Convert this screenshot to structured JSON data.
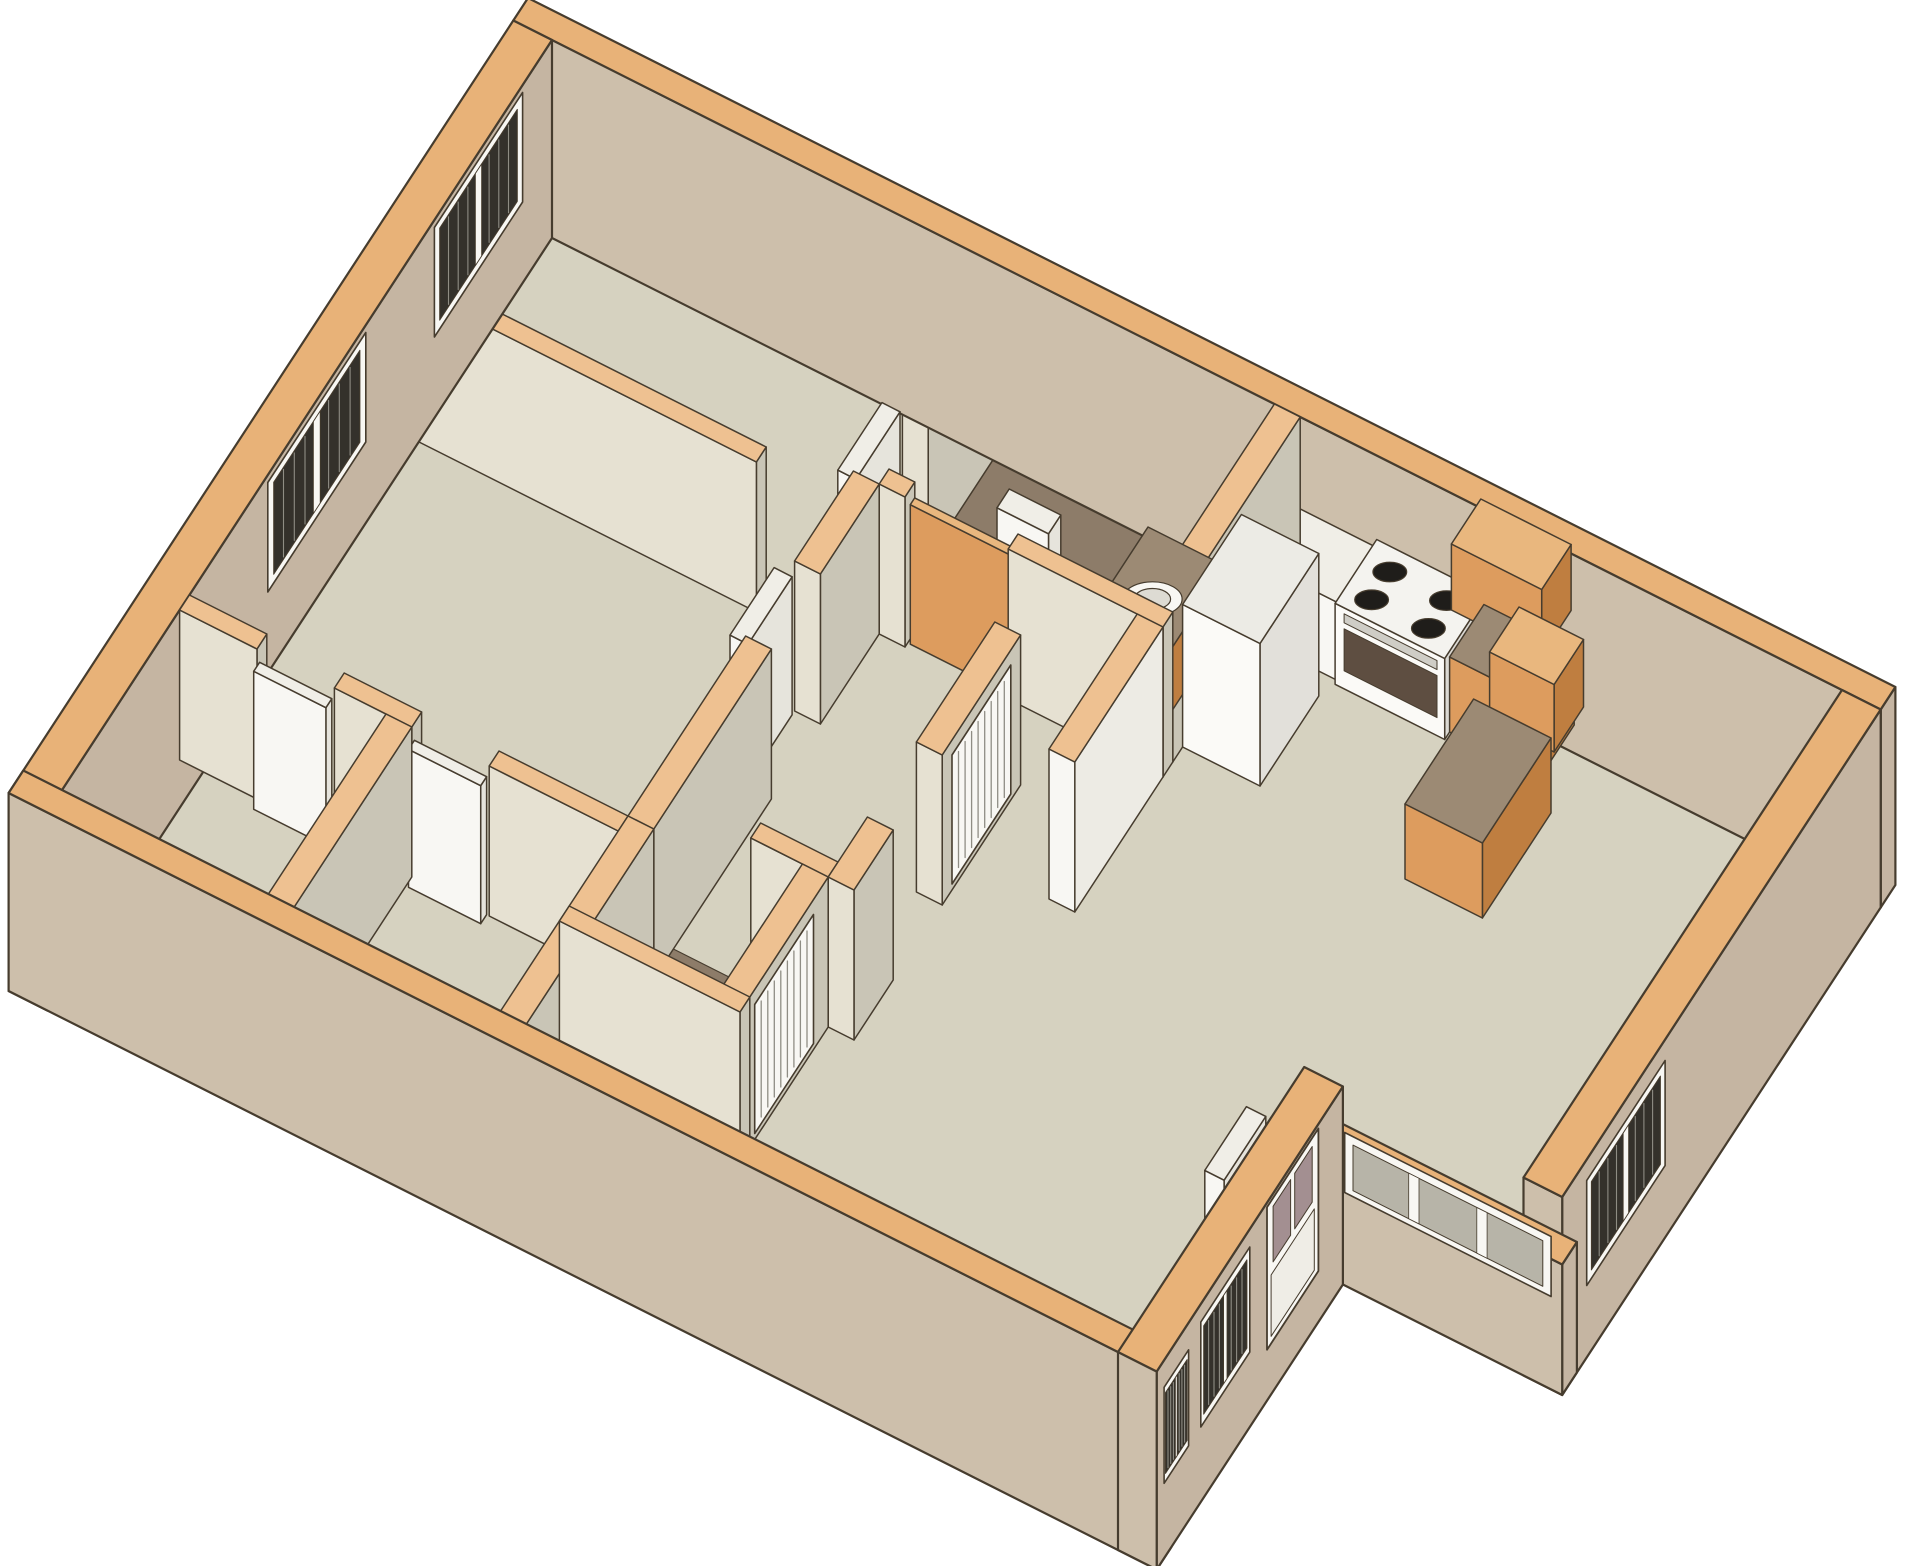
{
  "meta": {
    "title": "3D apartment floor plan",
    "description": "Isometric 3D cutaway floor plan of a two-bedroom apartment with two bedrooms on the left, a central hallway with louvered closets, two bathrooms with sinks and toilet, a kitchen with orange cabinets and a white stove, and an open living and dining area with an entry door and blinded windows"
  },
  "projection": {
    "origin": [
      552,
      190
    ],
    "u": [
      12.9,
      6.5
    ],
    "v": [
      -4.9,
      7.5
    ],
    "wall_height_px": 150,
    "slab_depth": -0.32,
    "canvas": [
      1920,
      1566
    ]
  },
  "colors": {
    "background": "#ffffff",
    "outline": "#463c2e",
    "floor": "#d6d2c0",
    "bathFloor": "#8d7c69",
    "topExt": "#e8b278",
    "topInt": "#eec191",
    "extS": "#cdbfab",
    "extE": "#c5b5a2",
    "intS": "#e6e1d2",
    "intE": "#c9c5b6",
    "white": "#f8f7f3",
    "whiteSide": "#e6e4dc",
    "whiteTop": "#f0eee7",
    "counterTop": "#9c8a74",
    "cabFace": "#dd9c5e",
    "cabSide": "#bf7e40",
    "cabTop": "#e9b77e",
    "glassDark": "#34312b",
    "glassLight": "#b7b4a8",
    "mauve": "#a38f91",
    "stoveFront": "#5e4e41",
    "line": "#8f8d84"
  },
  "floors": [
    {
      "n": "floor-main",
      "pts": [
        [
          0,
          0
        ],
        [
          100,
          0
        ],
        [
          100,
          65
        ],
        [
          83,
          65
        ],
        [
          83,
          100
        ],
        [
          0,
          100
        ]
      ],
      "f": "floor"
    },
    {
      "n": "floor-bathroom-1",
      "r": [
        36,
        56,
        2,
        26
      ],
      "f": "bathFloor"
    },
    {
      "n": "floor-bathroom-2",
      "r": [
        34,
        48,
        70,
        88
      ],
      "f": "bathFloor"
    }
  ],
  "items": [
    {
      "t": "wall",
      "n": "wall-north-exterior",
      "r": [
        -3,
        103,
        -3,
        0
      ],
      "ext": true
    },
    {
      "t": "wall",
      "n": "wall-west-exterior",
      "r": [
        -3,
        0,
        0,
        103
      ],
      "ext": true
    },
    {
      "t": "wall",
      "n": "wall-east-exterior",
      "r": [
        100,
        103,
        0,
        65
      ],
      "ext": true
    },
    {
      "t": "wall",
      "n": "wall-dining-sill",
      "r": [
        83,
        103,
        62,
        65
      ],
      "h": 0.55,
      "ext": true
    },
    {
      "t": "wall",
      "n": "wall-wing-east-exterior",
      "r": [
        83,
        86,
        65,
        103
      ],
      "ext": true
    },
    {
      "t": "wall",
      "n": "wall-south-exterior",
      "r": [
        -3,
        86,
        100,
        103
      ],
      "ext": true
    },
    {
      "t": "wall",
      "n": "wall-bedrooms-divider",
      "r": [
        0,
        28,
        30,
        32
      ]
    },
    {
      "t": "wall",
      "n": "wall-bedroom-a-east",
      "r": [
        34,
        36,
        0,
        18
      ]
    },
    {
      "t": "wall",
      "n": "wall-hall-west-a",
      "r": [
        34,
        36,
        28,
        40
      ]
    },
    {
      "t": "wall",
      "n": "wall-hall-west-b",
      "r": [
        34,
        36,
        50,
        74
      ]
    },
    {
      "t": "wall",
      "n": "wall-closets-east",
      "r": [
        34,
        36,
        74,
        100
      ]
    },
    {
      "t": "wall",
      "n": "wall-closets-north-a",
      "r": [
        0,
        6,
        74,
        76
      ]
    },
    {
      "t": "wall",
      "n": "wall-closets-north-b",
      "r": [
        12,
        18,
        74,
        76
      ]
    },
    {
      "t": "wall",
      "n": "wall-closets-north-c",
      "r": [
        24,
        34,
        74,
        76
      ]
    },
    {
      "t": "wall",
      "n": "wall-closets-divider",
      "r": [
        16,
        18,
        76,
        100
      ]
    },
    {
      "t": "wall",
      "n": "wall-bath1-south-a",
      "r": [
        36,
        38,
        26,
        28
      ]
    },
    {
      "t": "wall",
      "n": "wall-bath1-south-b",
      "r": [
        46,
        58,
        26,
        28
      ]
    },
    {
      "t": "wall",
      "n": "wall-kitchen-west",
      "r": [
        56,
        58,
        0,
        26
      ]
    },
    {
      "t": "wall",
      "n": "wall-white-panel",
      "r": [
        56,
        58,
        28,
        46
      ],
      "fs": "#f8f7f3",
      "fe": "#edebe4"
    },
    {
      "t": "wall",
      "n": "wall-hall-east-a",
      "r": [
        48,
        50,
        36,
        52
      ]
    },
    {
      "t": "wall",
      "n": "wall-hall-east-b",
      "r": [
        48,
        50,
        62,
        70
      ]
    },
    {
      "t": "wall",
      "n": "wall-bath2-north",
      "r": [
        42,
        48,
        68,
        70
      ]
    },
    {
      "t": "wall",
      "n": "wall-bath2-east",
      "r": [
        46,
        48,
        70,
        88
      ]
    },
    {
      "t": "wall",
      "n": "wall-bath2-south",
      "r": [
        34,
        48,
        86,
        88
      ]
    },
    {
      "t": "box",
      "n": "kitchen-sink-cabinet",
      "r": [
        58,
        64.5,
        2,
        9.5
      ],
      "h": 0.52,
      "white": true
    },
    {
      "t": "box",
      "n": "stove",
      "r": [
        64.5,
        73,
        1.5,
        10
      ],
      "h": 0.54,
      "fs": "#fbfaf7",
      "fe": "#dbd9d3",
      "ft": "#f4f3ef"
    },
    {
      "t": "panel",
      "n": "oven-door",
      "plane": "Y",
      "y": 10,
      "x0": 65.2,
      "x1": 72.4,
      "z0": 0.12,
      "z1": 0.4,
      "f": "stoveFront",
      "k": 75.2
    },
    {
      "t": "panel",
      "n": "oven-handle",
      "plane": "Y",
      "y": 10,
      "x0": 65.2,
      "x1": 72.4,
      "z0": 0.44,
      "z1": 0.5,
      "f": "#cfcdc6",
      "k": 75.25
    },
    {
      "t": "ellipse",
      "n": "stove-burner-1",
      "c": [
        66.5,
        4.1
      ],
      "r": 1.25,
      "z": 0.54,
      "f": "#1f1d1a",
      "k": 75.3
    },
    {
      "t": "ellipse",
      "n": "stove-burner-2",
      "c": [
        70.9,
        4.1
      ],
      "r": 1.25,
      "z": 0.54,
      "f": "#1f1d1a",
      "k": 75.32
    },
    {
      "t": "ellipse",
      "n": "stove-burner-3",
      "c": [
        66.5,
        7.8
      ],
      "r": 1.25,
      "z": 0.54,
      "f": "#1f1d1a",
      "k": 75.34
    },
    {
      "t": "ellipse",
      "n": "stove-burner-4",
      "c": [
        70.9,
        7.8
      ],
      "r": 1.25,
      "z": 0.54,
      "f": "#1f1d1a",
      "k": 75.36
    },
    {
      "t": "box",
      "n": "kitchen-counter-north-east",
      "r": [
        73,
        80,
        2,
        9
      ],
      "h": 0.5,
      "cab": true
    },
    {
      "t": "box",
      "n": "kitchen-upper-cabinet-1",
      "r": [
        72,
        79,
        0,
        6
      ],
      "zb": 0.62,
      "h": 1.06,
      "cab": true,
      "ft": "cabTop"
    },
    {
      "t": "box",
      "n": "kitchen-upper-cabinet-2",
      "r": [
        78,
        83,
        8,
        14
      ],
      "zb": 0.55,
      "h": 1.0,
      "cab": true,
      "ft": "cabTop"
    },
    {
      "t": "box",
      "n": "kitchen-base-cabinet-east",
      "r": [
        76,
        82,
        12,
        26
      ],
      "h": 0.5,
      "cab": true
    },
    {
      "t": "box",
      "n": "refrigerator",
      "r": [
        58,
        64,
        12,
        24
      ],
      "h": 0.95,
      "fs": "#fbfaf7",
      "fe": "#e2e0da",
      "ft": "#ecebe5"
    },
    {
      "t": "box",
      "n": "toilet-tank",
      "r": [
        40,
        44,
        12,
        14.5
      ],
      "h": 0.34,
      "white": true
    },
    {
      "t": "ellipse",
      "n": "toilet-bowl",
      "c": [
        42,
        17.6
      ],
      "r": 2.3,
      "z": 0.2,
      "f": "white",
      "k": 56
    },
    {
      "t": "ellipse",
      "n": "toilet-bowl-inner",
      "c": [
        42,
        17.6
      ],
      "r": 1.4,
      "z": 0.2,
      "f": "#e4e2da",
      "k": 56.1
    },
    {
      "t": "box",
      "n": "bath1-vanity",
      "r": [
        50,
        56,
        10,
        24
      ],
      "h": 0.42,
      "cab": true
    },
    {
      "t": "ellipse",
      "n": "bath1-sink",
      "c": [
        53,
        17
      ],
      "r": 2.2,
      "z": 0.42,
      "f": "white",
      "k": 70.4
    },
    {
      "t": "ellipse",
      "n": "bath1-sink-basin",
      "c": [
        53,
        17
      ],
      "r": 1.35,
      "z": 0.42,
      "f": "#dddbd3",
      "k": 70.5
    },
    {
      "t": "box",
      "n": "bath2-vanity",
      "r": [
        36,
        44,
        78,
        86
      ],
      "h": 0.42,
      "cab": true
    },
    {
      "t": "ellipse",
      "n": "bath2-sink",
      "c": [
        40,
        82
      ],
      "r": 2.2,
      "z": 0.42,
      "f": "white",
      "k": 122.4
    },
    {
      "t": "ellipse",
      "n": "bath2-sink-basin",
      "c": [
        40,
        82
      ],
      "r": 1.35,
      "z": 0.42,
      "f": "#dddbd3",
      "k": 122.5
    },
    {
      "t": "box",
      "n": "bath1-sliding-door",
      "r": [
        38.2,
        45.8,
        26.55,
        27.45
      ],
      "h": 0.93,
      "cab": true,
      "ft": "cabTop"
    },
    {
      "t": "box",
      "n": "bedroom-a-door-leaf",
      "r": [
        32.6,
        34,
        18.5,
        27.5
      ],
      "h": 0.92,
      "white": true
    },
    {
      "t": "box",
      "n": "bedroom-b-door-leaf",
      "r": [
        32.6,
        34,
        40.5,
        49.5
      ],
      "h": 0.92,
      "white": true
    },
    {
      "t": "box",
      "n": "closet-door-leaf-1",
      "r": [
        6.2,
        11.8,
        76,
        77.2
      ],
      "h": 0.92,
      "white": true
    },
    {
      "t": "box",
      "n": "closet-door-leaf-2",
      "r": [
        18.2,
        23.8,
        76,
        77.2
      ],
      "h": 0.92,
      "white": true
    },
    {
      "t": "box",
      "n": "entry-door-leaf",
      "r": [
        80.8,
        82.3,
        71,
        79.5
      ],
      "h": 0.94,
      "white": true
    },
    {
      "t": "win",
      "n": "window-bedroom-a",
      "plane": "X",
      "x": 0,
      "y0": 6,
      "y1": 24,
      "z0": 0.22,
      "z1": 0.95,
      "style": "blinds",
      "k": 50.6
    },
    {
      "t": "win",
      "n": "window-bedroom-b",
      "plane": "X",
      "x": 0,
      "y0": 38,
      "y1": 58,
      "z0": 0.22,
      "z1": 0.95,
      "style": "blinds",
      "k": 50.7
    },
    {
      "t": "win",
      "n": "window-east",
      "plane": "X",
      "x": 103,
      "y0": 44,
      "y1": 60,
      "z0": 0.16,
      "z1": 0.86,
      "style": "blinds",
      "k": 134.6
    },
    {
      "t": "door",
      "n": "entry-door",
      "plane": "X",
      "x": 86,
      "y0": 70,
      "y1": 80.5,
      "z0": 0.02,
      "z1": 0.97,
      "k": 169
    },
    {
      "t": "win",
      "n": "window-wing-1",
      "plane": "X",
      "x": 86,
      "y0": 84,
      "y1": 94,
      "z0": 0.18,
      "z1": 0.88,
      "style": "blinds",
      "k": 169.1
    },
    {
      "t": "win",
      "n": "window-wing-2",
      "plane": "X",
      "x": 86,
      "y0": 96.5,
      "y1": 101.5,
      "z0": 0.18,
      "z1": 0.82,
      "style": "blinds",
      "k": 169.2
    },
    {
      "t": "win",
      "n": "window-dining-sill",
      "plane": "Y",
      "y": 62,
      "x0": 85,
      "x1": 101,
      "z0": 0.1,
      "z1": 0.5,
      "style": "sill",
      "k": 157
    },
    {
      "t": "louver",
      "n": "hall-closet-louver-doors",
      "plane": "X",
      "x": 50,
      "y0": 38,
      "y1": 50,
      "z0": 0.04,
      "z1": 0.9,
      "k": 93.6
    },
    {
      "t": "louver",
      "n": "bath2-louver-door",
      "plane": "X",
      "x": 48,
      "y0": 73,
      "y1": 85,
      "z0": 0.04,
      "z1": 0.9,
      "k": 126.6
    }
  ]
}
